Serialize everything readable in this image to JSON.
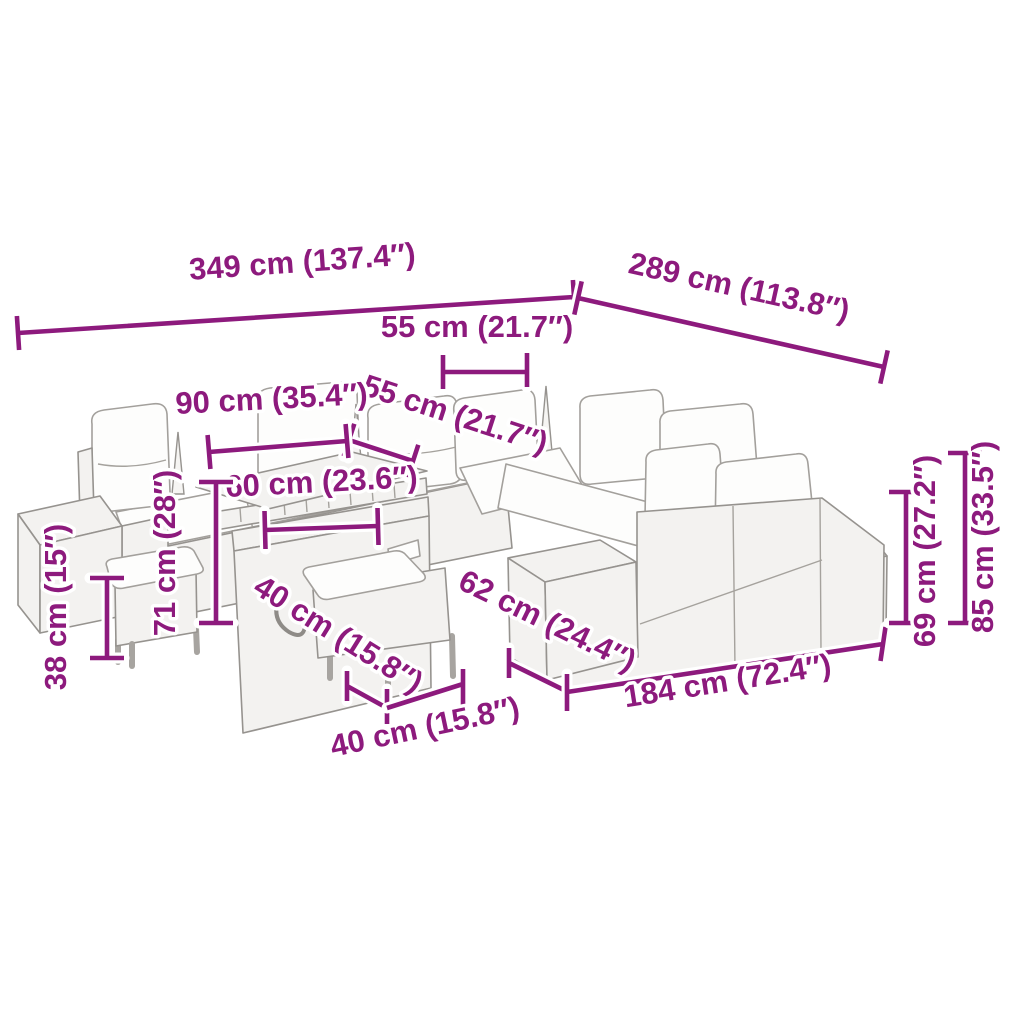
{
  "diagram": {
    "type": "product-dimension-diagram",
    "colors": {
      "dimension_accent": "#8d1a7d",
      "artwork_line": "#96938f",
      "background": "#ffffff"
    }
  },
  "measurements": {
    "overall_width": {
      "cm": 349,
      "inches": 137.4,
      "label": "349 cm (137.4″)"
    },
    "overall_depth": {
      "cm": 289,
      "inches": 113.8,
      "label": "289 cm (113.8″)"
    },
    "seat_width": {
      "cm": 55,
      "inches": 21.7,
      "label": "55 cm (21.7″)"
    },
    "seat_depth": {
      "cm": 55,
      "inches": 21.7,
      "label": "55 cm (21.7″)"
    },
    "table_top_length": {
      "cm": 90,
      "inches": 35.4,
      "label": "90 cm (35.4″)"
    },
    "table_storage_length": {
      "cm": 60,
      "inches": 23.6,
      "label": "60 cm (23.6″)"
    },
    "table_height": {
      "cm": 71,
      "inches": 28,
      "label": "71 cm (28″)"
    },
    "stool_height": {
      "cm": 38,
      "inches": 15,
      "label": "38 cm (15″)"
    },
    "stool_depth": {
      "cm": 40,
      "inches": 15.8,
      "label": "40 cm (15.8″)"
    },
    "stool_width": {
      "cm": 40,
      "inches": 15.8,
      "label": "40 cm (15.8″)"
    },
    "ottoman_depth": {
      "cm": 62,
      "inches": 24.4,
      "label": "62 cm (24.4″)"
    },
    "bench_length": {
      "cm": 184,
      "inches": 72.4,
      "label": "184 cm (72.4″)"
    },
    "backrest_height": {
      "cm": 69,
      "inches": 27.2,
      "label": "69 cm (27.2″)"
    },
    "total_height": {
      "cm": 85,
      "inches": 33.5,
      "label": "85 cm (33.5″)"
    }
  }
}
